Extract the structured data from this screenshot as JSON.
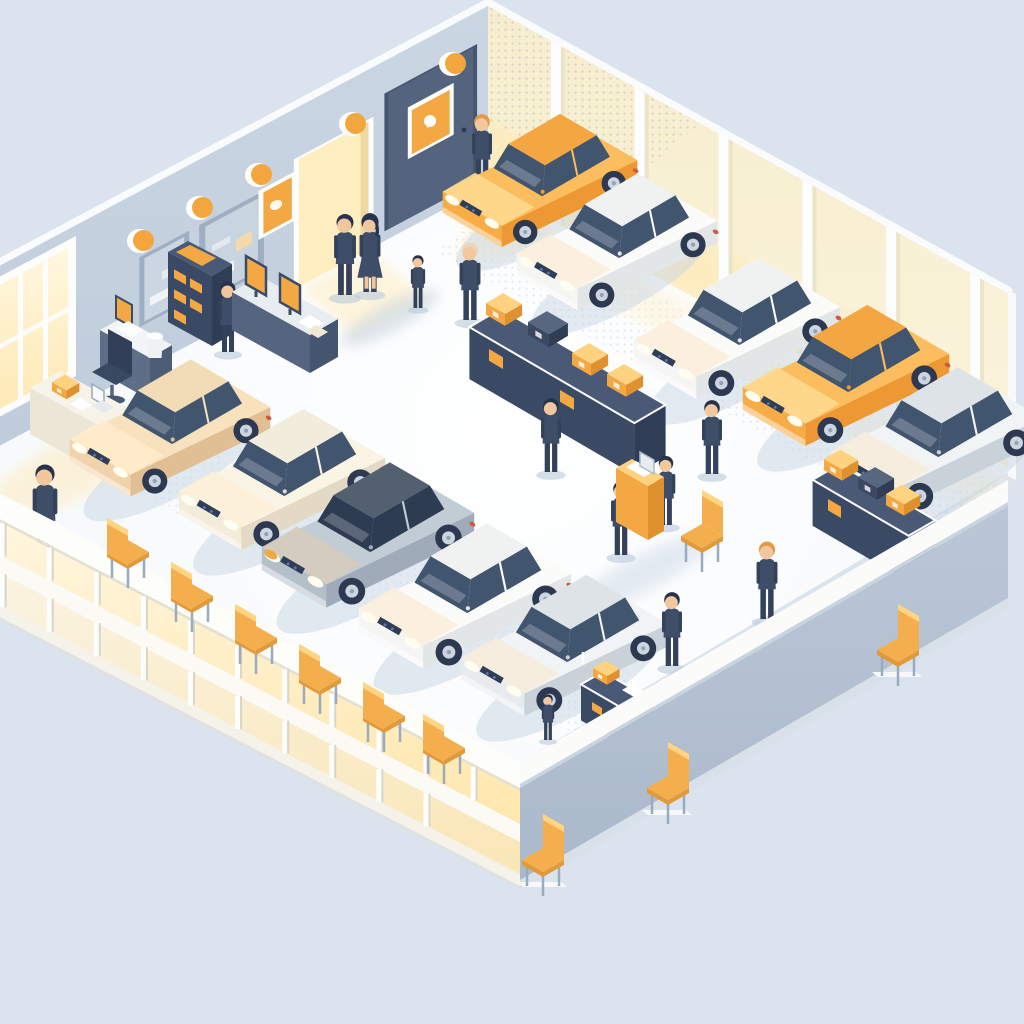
{
  "scene": {
    "type": "isometric-illustration",
    "setting": "car dealership showroom, cutaway room with customers, sales staff, parked sedans, auction podium, parts shelves and orange chairs",
    "cars": [
      {
        "id": 1,
        "color": "orange",
        "kind": "sedan",
        "location": "top entrance"
      },
      {
        "id": 2,
        "color": "white",
        "kind": "sedan",
        "location": "right wall row"
      },
      {
        "id": 3,
        "color": "white",
        "kind": "sedan",
        "location": "right wall row"
      },
      {
        "id": 4,
        "color": "orange",
        "kind": "sedan",
        "location": "right wall row"
      },
      {
        "id": 5,
        "color": "silver",
        "kind": "suv",
        "location": "right wall row"
      },
      {
        "id": 6,
        "color": "tan",
        "kind": "sedan",
        "location": "left row"
      },
      {
        "id": 7,
        "color": "cream",
        "kind": "sedan",
        "location": "left row"
      },
      {
        "id": 8,
        "color": "gray",
        "kind": "sedan",
        "location": "left row"
      },
      {
        "id": 9,
        "color": "white",
        "kind": "sedan",
        "location": "left row"
      },
      {
        "id": 10,
        "color": "silver",
        "kind": "sedan",
        "location": "left row"
      }
    ],
    "people_count": 14,
    "chairs_count": 10,
    "wall_lamps_count": 5,
    "furniture": [
      "office desk with chair",
      "reception counter with laptop",
      "brochure kiosk",
      "wall counter with two monitors",
      "long parts shelf with boxes",
      "small parts shelf with boxes",
      "display cart",
      "auction podium with laptop"
    ]
  },
  "palette": {
    "bg": "#dbe4ee",
    "wall_top_edge": "#fafbfc",
    "wall_left_top": "#cbd6e3",
    "wall_left_bottom": "#bfccdb",
    "wall_right_top": "#f7edcd",
    "wall_right_bottom": "#fbf4dc",
    "wall_right_glow": "#ffe9ae",
    "pillar_white": "#fbfdfe",
    "pillar_shade": "#ece4c8",
    "floor_white": "#f7fafc",
    "floor_shadow": "#c7d5e4",
    "dot_color": "#a9b8c9",
    "facade_white": "#fdfdfa",
    "facade_glow": "#ffe9b4",
    "parapet_top": "#bac7d6",
    "parapet_bottom": "#aab9cb",
    "parapet_slab": "#fbfcfa",
    "navy_top": "#4a5a76",
    "navy_front": "#3a4964",
    "navy_side": "#2f3d56",
    "orange_accent": "#f3a843",
    "orange_light": "#ffd27f",
    "orange_deep": "#e0912f",
    "orange_front": "#f8ac45",
    "orange_side": "#ee9833",
    "orange_top": "#fbbd5e",
    "orange_hood": "#ffd98f",
    "orange_roof": "#f3a642",
    "window_navy": "#42556f",
    "window_dark": "#2e3c52",
    "suit_navy": "#3e4d68",
    "suit_dark": "#33415a",
    "skin": "#f3c79d",
    "hair_dark": "#26334b",
    "hair_ginger": "#e6984b",
    "hair_blond": "#e8d8ba",
    "tire": "#2d3950",
    "hub": "#ccd5e0",
    "chair_orange": "#f5ae4d",
    "chair_orange_light": "#ffd584",
    "chair_leg": "#9aabbd",
    "lamp_orange": "#f4a63e",
    "door_navy": "#54647e",
    "doorway_yellow": "#ffeec0",
    "taillight": "#cc5a47"
  }
}
